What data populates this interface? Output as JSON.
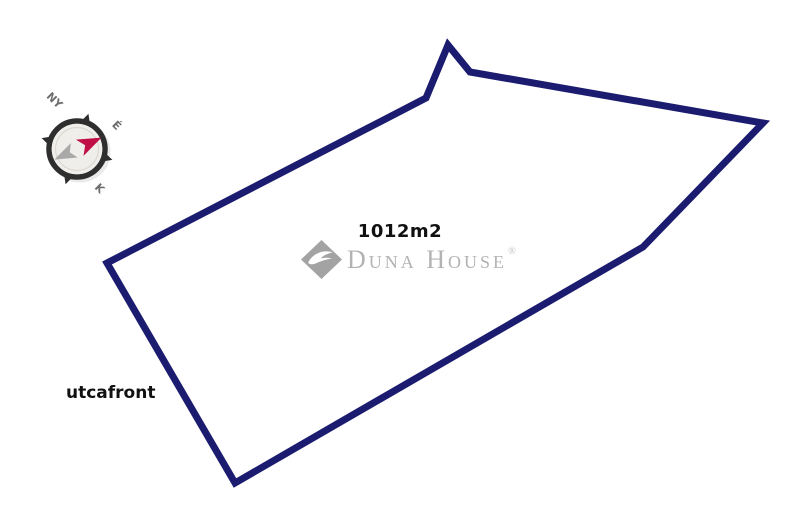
{
  "canvas": {
    "width": 800,
    "height": 524,
    "background": "#ffffff"
  },
  "plot": {
    "area_label": "1012m2",
    "street_label": "utcafront",
    "outline_color": "#1b1b70",
    "outline_width": 7,
    "vertices": [
      [
        107,
        263
      ],
      [
        426,
        98
      ],
      [
        448,
        45
      ],
      [
        470,
        72
      ],
      [
        763,
        123
      ],
      [
        643,
        247
      ],
      [
        235,
        483
      ]
    ]
  },
  "compass": {
    "label_west": "NY",
    "label_north": "É",
    "label_east": "K",
    "ring_color": "#2e2e2e",
    "face_color": "#f0eeea",
    "inner_line_color": "#dcd8d2",
    "north_needle_color": "#c00e47",
    "south_needle_color": "#a9a9a9",
    "label_color": "#6d6d6d"
  },
  "watermark": {
    "brand": "Duna House",
    "registered_mark": "®",
    "text_color": "#a6a6a6",
    "diamond_color": "#949494"
  }
}
